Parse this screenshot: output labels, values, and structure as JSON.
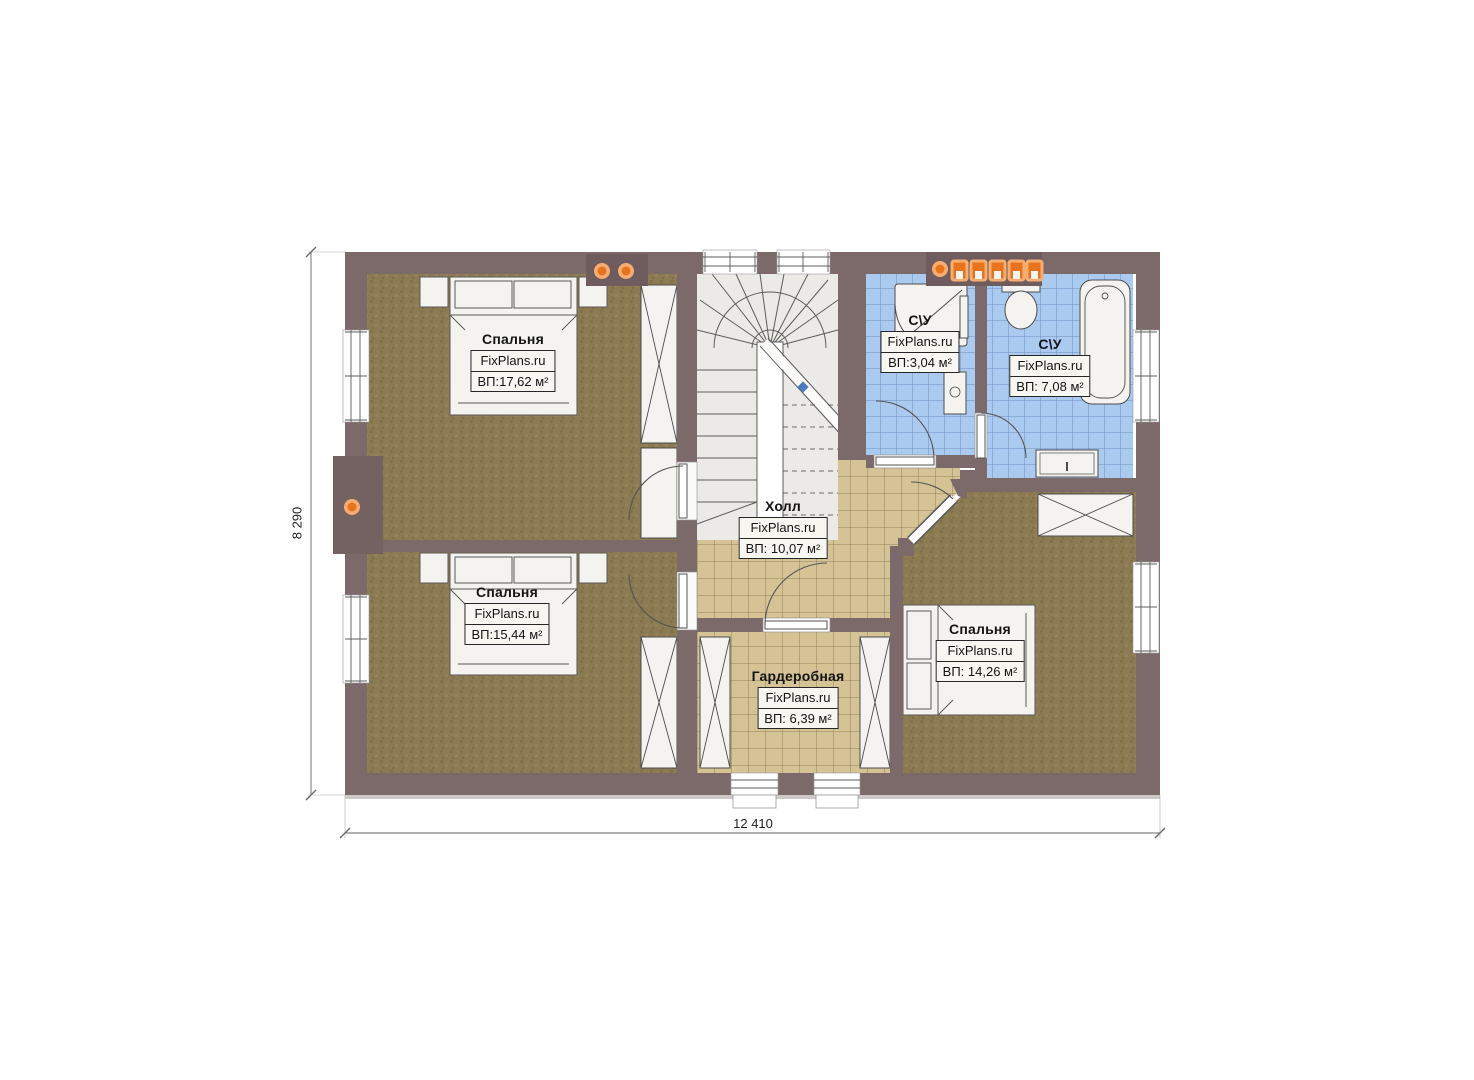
{
  "plan": {
    "rooms": [
      {
        "id": "bedroom-top-left",
        "name": "Спальня",
        "brand": "FixPlans.ru",
        "area": "ВП:17,62 м²"
      },
      {
        "id": "bedroom-bottom-left",
        "name": "Спальня",
        "brand": "FixPlans.ru",
        "area": "ВП:15,44 м²"
      },
      {
        "id": "bedroom-bottom-right",
        "name": "Спальня",
        "brand": "FixPlans.ru",
        "area": "ВП: 14,26 м²"
      },
      {
        "id": "hall",
        "name": "Холл",
        "brand": "FixPlans.ru",
        "area": "ВП: 10,07 м²"
      },
      {
        "id": "wardrobe",
        "name": "Гардеробная",
        "brand": "FixPlans.ru",
        "area": "ВП: 6,39 м²"
      },
      {
        "id": "bathroom-small",
        "name": "С\\У",
        "brand": "FixPlans.ru",
        "area": "ВП:3,04 м²"
      },
      {
        "id": "bathroom-large",
        "name": "С\\У",
        "brand": "FixPlans.ru",
        "area": "ВП: 7,08 м²"
      }
    ],
    "dimensions": {
      "width_label": "12 410",
      "height_label": "8 290"
    },
    "features": {
      "vent_dots_top_left": 2,
      "vent_dots_top_right": 6,
      "vent_dots_left_wall": 1
    },
    "colors": {
      "wall": "#7c6a6b",
      "chimney": "#746162",
      "bedroom_floor": "#8b7a52",
      "hall_tile": "#d5c295",
      "bath_tile": "#abcaf0",
      "accent_orange": "#e8731c",
      "fixture_white": "#f4f3ef",
      "stair_fill": "#eceae6"
    }
  }
}
